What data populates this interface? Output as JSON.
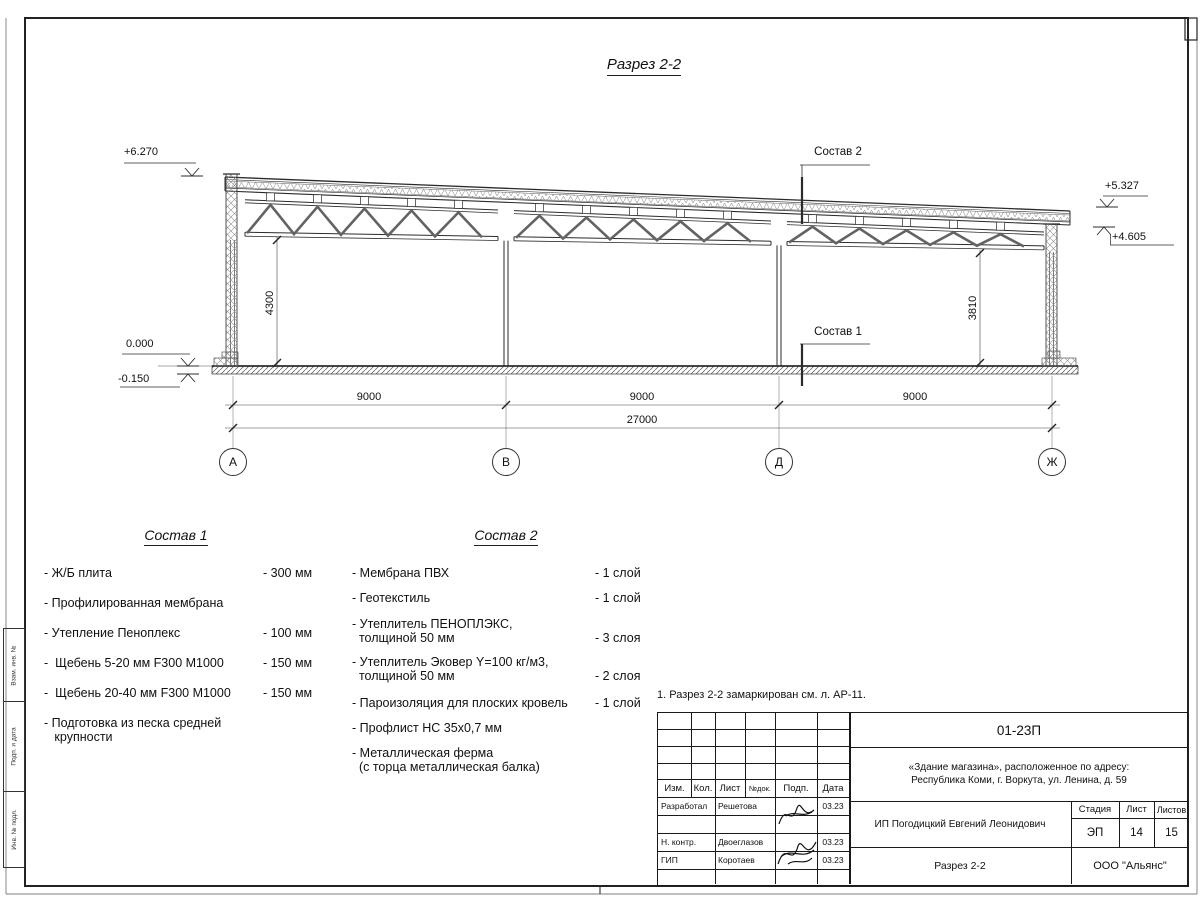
{
  "sheet": {
    "title": "Разрез 2-2",
    "note": "1. Разрез 2-2 замаркирован см. л. АР-11."
  },
  "drawing": {
    "elevations": {
      "left_top": "+6.270",
      "zero": "0.000",
      "below_zero": "-0.150",
      "right_top": "+5.327",
      "right_under": "+4.605"
    },
    "vertical_dims": {
      "left": "4300",
      "right": "3810"
    },
    "spans": [
      "9000",
      "9000",
      "9000"
    ],
    "total_span": "27000",
    "axes": [
      "А",
      "В",
      "Д",
      "Ж"
    ],
    "callout_top": "Состав 2",
    "callout_floor": "Состав 1"
  },
  "sostav1": {
    "title": "Состав 1",
    "items": [
      {
        "name": "- Ж/Б плита",
        "value": "- 300 мм"
      },
      {
        "name": "- Профилированная мембрана",
        "value": ""
      },
      {
        "name": "- Утепление Пеноплекс",
        "value": "- 100 мм"
      },
      {
        "name": "-  Щебень 5-20 мм F300 М1000",
        "value": "- 150 мм"
      },
      {
        "name": "-  Щебень 20-40 мм F300 М1000",
        "value": "- 150 мм"
      },
      {
        "name": "- Подготовка из песка средней\n   крупности",
        "value": ""
      }
    ]
  },
  "sostav2": {
    "title": "Состав 2",
    "items": [
      {
        "name": "- Мембрана ПВХ",
        "value": "- 1 слой"
      },
      {
        "name": "- Геотекстиль",
        "value": "- 1 слой"
      },
      {
        "name": "- Утеплитель ПЕНОПЛЭКС,\n  толщиной 50 мм",
        "value": "- 3 слоя"
      },
      {
        "name": "- Утеплитель Эковер Y=100 кг/м3,\n  толщиной 50 мм",
        "value": "- 2 слоя"
      },
      {
        "name": "- Пароизоляция для плоских кровель",
        "value": "- 1 слой"
      },
      {
        "name": "- Профлист НС 35х0,7 мм",
        "value": ""
      },
      {
        "name": "- Металлическая ферма\n  (с торца металлическая балка)",
        "value": ""
      }
    ]
  },
  "titleblock": {
    "doc_number": "01-23П",
    "project": "«Здание магазина», расположенное по адресу:\nРеспублика Коми, г. Воркута, ул. Ленина, д. 59",
    "headers": {
      "izm": "Изм.",
      "kol": "Кол.",
      "list": "Лист",
      "ndok": "№док.",
      "podp": "Подп.",
      "data": "Дата"
    },
    "rows": [
      {
        "role": "Разработал",
        "name": "Решетова",
        "date": "03.23"
      },
      {
        "role": "Н. контр.",
        "name": "Двоеглазов",
        "date": "03.23"
      },
      {
        "role": "ГИП",
        "name": "Коротаев",
        "date": "03.23"
      }
    ],
    "client": "ИП Погодицкий Евгений Леонидович",
    "stage_label": "Стадия",
    "stage": "ЭП",
    "sheet_label": "Лист",
    "sheet": "14",
    "sheets_label": "Листов",
    "sheets": "15",
    "drawing_name": "Разрез 2-2",
    "company": "ООО \"Альянс\""
  },
  "frame": {
    "side_labels": [
      "Взам. инв. №",
      "Подп. и дата",
      "Инв. № подл."
    ]
  }
}
